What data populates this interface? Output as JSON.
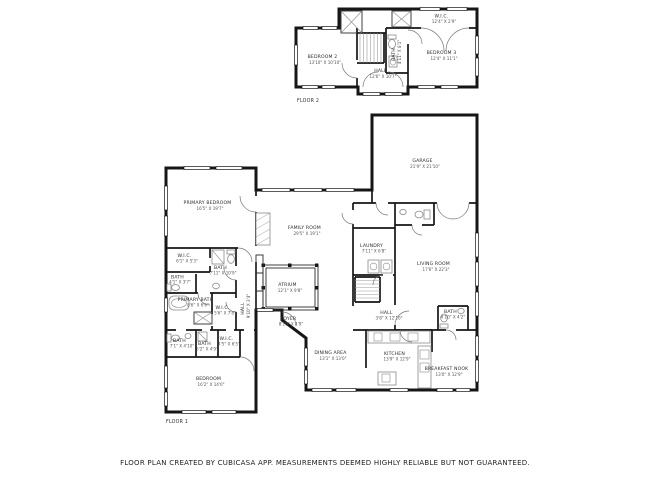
{
  "footer": {
    "disclaimer": "FLOOR PLAN CREATED BY CUBICASA APP. MEASUREMENTS DEEMED HIGHLY RELIABLE BUT NOT GUARANTEED."
  },
  "floor2": {
    "label": "FLOOR 2",
    "rooms": {
      "bedroom2": {
        "name": "BEDROOM 2",
        "dims": "13'10\" X 10'10\""
      },
      "hall": {
        "name": "HALL",
        "dims": "12'6\" X 10'7\""
      },
      "bath": {
        "name": "BATH",
        "dims": "4'11\" X 8'1\""
      },
      "wic": {
        "name": "W.I.C.",
        "dims": "12'4\" X 2'9\""
      },
      "bedroom3": {
        "name": "BEDROOM 3",
        "dims": "12'4\" X 11'1\""
      }
    }
  },
  "floor1": {
    "label": "FLOOR 1",
    "rooms": {
      "primary_bedroom": {
        "name": "PRIMARY BEDROOM",
        "dims": "16'5\" X 19'7\""
      },
      "wic_a": {
        "name": "W.I.C.",
        "dims": "6'1\" X 5'3\""
      },
      "bath_a": {
        "name": "BATH",
        "dims": "7'11\" X 10'9\""
      },
      "bath_b": {
        "name": "BATH",
        "dims": "4'1\" X 3'7\""
      },
      "primary_bath": {
        "name": "PRIMARY BATH",
        "dims": "8'6\" X 6'6\""
      },
      "wic_b": {
        "name": "W.I.C.",
        "dims": "5'6\" X 7'8\""
      },
      "hall_a": {
        "name": "HALL",
        "dims": "9'10\" X 3'4\""
      },
      "bath_c": {
        "name": "BATH",
        "dims": "7'1\" X 4'10\""
      },
      "bath_d": {
        "name": "BATH",
        "dims": "5'2\" X 4'9\""
      },
      "wic_c": {
        "name": "W.I.C.",
        "dims": "4'5\" X 6'5\""
      },
      "bedroom": {
        "name": "BEDROOM",
        "dims": "16'2\" X 14'0\""
      },
      "family_room": {
        "name": "FAMILY ROOM",
        "dims": "29'5\" X 19'1\""
      },
      "atrium": {
        "name": "ATRIUM",
        "dims": "12'1\" X 9'8\""
      },
      "garage": {
        "name": "GARAGE",
        "dims": "21'9\" X 21'10\""
      },
      "laundry": {
        "name": "LAUNDRY",
        "dims": "7'11\" X 6'8\""
      },
      "living_room": {
        "name": "LIVING ROOM",
        "dims": "17'6\" X 22'3\""
      },
      "foyer": {
        "name": "FOYER",
        "dims": "8'10\" X 4'9\""
      },
      "hall_b": {
        "name": "HALL",
        "dims": "3'8\" X 12'10\""
      },
      "dining_area": {
        "name": "DINING AREA",
        "dims": "13'1\" X 13'0\""
      },
      "kitchen": {
        "name": "KITCHEN",
        "dims": "13'9\" X 12'9\""
      },
      "breakfast_nook": {
        "name": "BREAKFAST NOOK",
        "dims": "13'0\" X 12'9\""
      },
      "bath_e": {
        "name": "BATH",
        "dims": "4'10\" X 4'2\""
      }
    }
  }
}
